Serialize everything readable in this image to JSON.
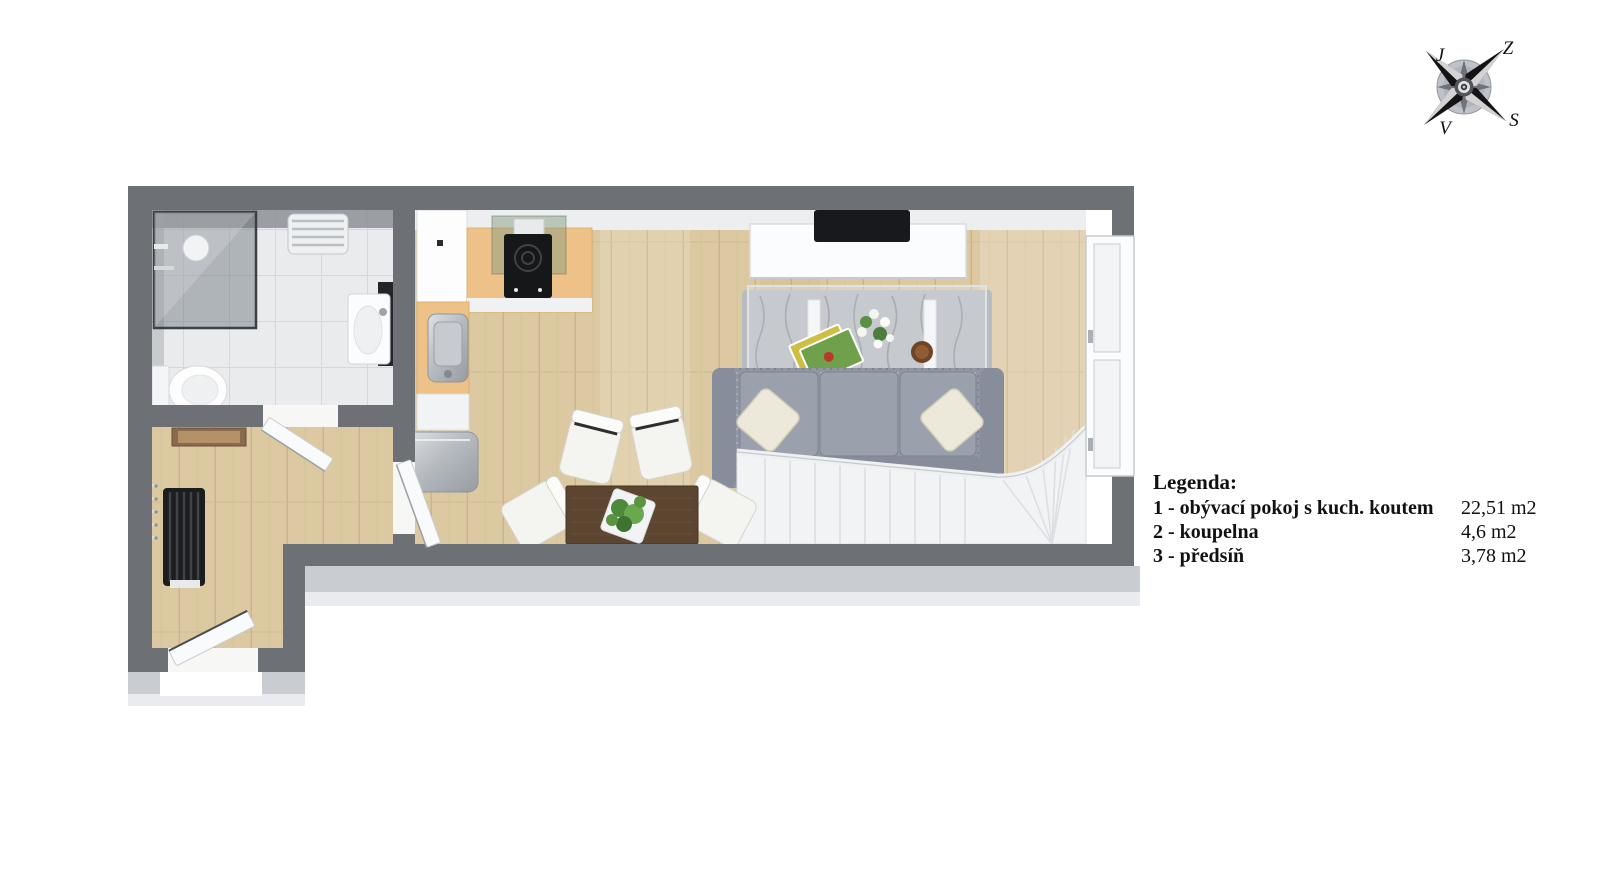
{
  "legend": {
    "title": "Legenda:",
    "items": [
      {
        "label": "1 - obývací pokoj s kuch. koutem",
        "area": "22,51 m2"
      },
      {
        "label": "2 - koupelna",
        "area": "4,6 m2"
      },
      {
        "label": "3 - předsíň",
        "area": "3,78 m2"
      }
    ]
  },
  "compass": {
    "nw": "J",
    "ne": "Z",
    "sw": "V",
    "se": "S"
  },
  "colors": {
    "wall": "#6d7176",
    "wood_floor": "#dcc9a2",
    "tile_floor": "#e9ebed",
    "counter_beech": "#eec189",
    "sofa_gray": "#9096a2",
    "exterior_shadow": "#c9ccd1",
    "plant_green": "#4e8a3c",
    "table_brown": "#5c4531"
  }
}
